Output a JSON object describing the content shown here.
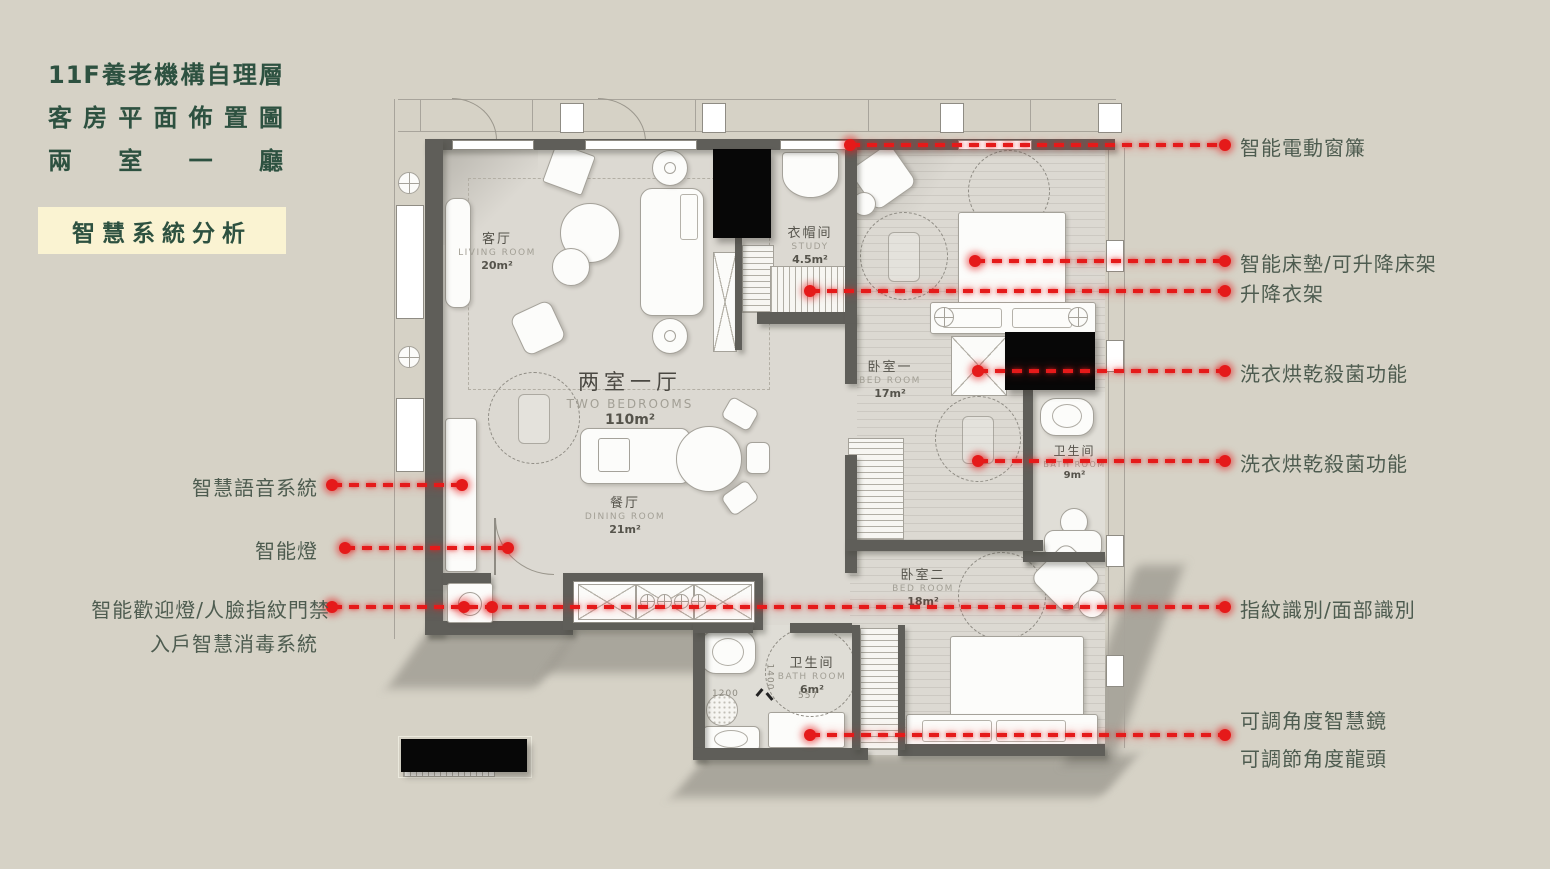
{
  "slide": {
    "background": "#d6d2c6",
    "accent_red": "#e51a1a",
    "title_color": "#2d5140",
    "title_lines": [
      "11F養老機構自理層",
      "客房平面佈置圖",
      "兩室一廳"
    ],
    "badge": {
      "label": "智慧系統分析",
      "bg": "#faf3d2"
    }
  },
  "floor_plan": {
    "unit_label": {
      "cn": "两室一厅",
      "en": "TWO BEDROOMS",
      "area": "110m²"
    },
    "rooms": {
      "living": {
        "cn": "客厅",
        "en": "LIVING ROOM",
        "area": "20m²"
      },
      "wardrobe": {
        "cn": "衣帽间",
        "en": "STUDY",
        "area": "4.5m²"
      },
      "dining": {
        "cn": "餐厅",
        "en": "DINING ROOM",
        "area": "21m²"
      },
      "bedroom1": {
        "cn": "卧室一",
        "en": "BED ROOM",
        "area": "17m²"
      },
      "bathroom1": {
        "cn": "卫生间",
        "en": "BATH ROOM",
        "area": "9m²"
      },
      "bedroom2": {
        "cn": "卧室二",
        "en": "BED ROOM",
        "area": "18m²"
      },
      "bathroom2": {
        "cn": "卫生间",
        "en": "BATH ROOM",
        "area": "6m²"
      }
    },
    "dimensions": [
      "1200",
      "1400",
      "557"
    ]
  },
  "annotations": {
    "left": [
      {
        "label": "智慧語音系統"
      },
      {
        "label": "智能燈"
      },
      {
        "label": "智能歡迎燈/人臉指紋門禁"
      },
      {
        "label": "入戶智慧消毒系統"
      }
    ],
    "right": [
      {
        "label": "智能電動窗簾"
      },
      {
        "label": "智能床墊/可升降床架"
      },
      {
        "label": "升降衣架"
      },
      {
        "label": "洗衣烘乾殺菌功能"
      },
      {
        "label": "洗衣烘乾殺菌功能"
      },
      {
        "label": "指紋識別/面部識別"
      },
      {
        "label": "可調角度智慧鏡"
      },
      {
        "label": "可調節角度龍頭"
      }
    ]
  }
}
